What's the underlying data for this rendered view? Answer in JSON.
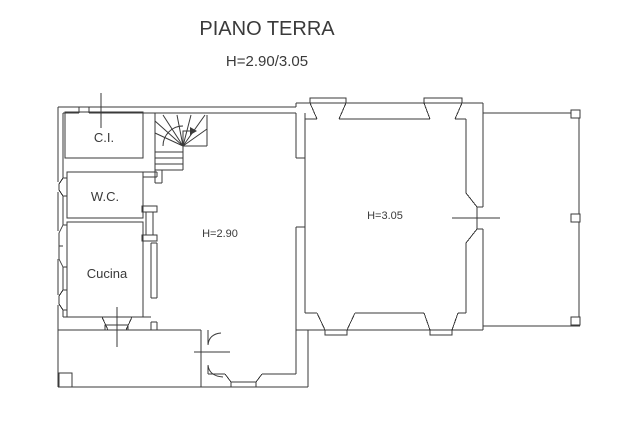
{
  "title": "PIANO TERRA",
  "subtitle": "H=2.90/3.05",
  "plan": {
    "rooms": [
      {
        "id": "ci",
        "label": "C.I."
      },
      {
        "id": "wc",
        "label": "W.C."
      },
      {
        "id": "cucina",
        "label": "Cucina"
      },
      {
        "id": "room290",
        "label": "H=2.90"
      },
      {
        "id": "room305",
        "label": "H=3.05"
      }
    ],
    "colors": {
      "line": "#3a3a3a",
      "background": "#ffffff"
    }
  }
}
